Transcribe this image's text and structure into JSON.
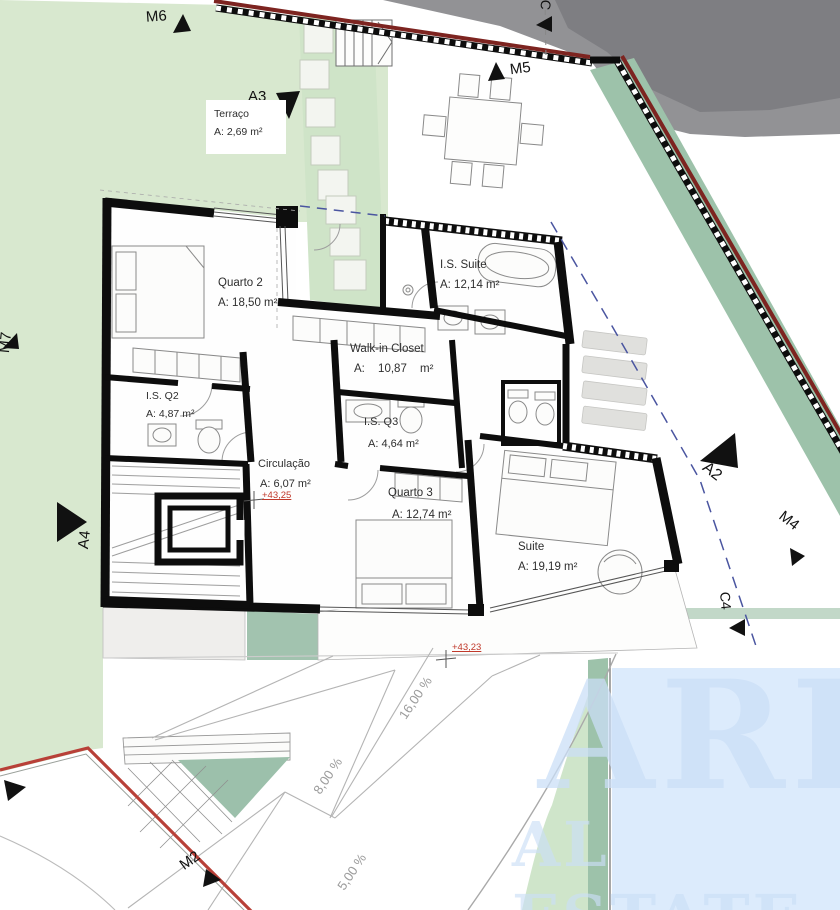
{
  "rooms": {
    "terraco": {
      "name": "Terraço",
      "area": "A: 2,69 m²"
    },
    "quarto2": {
      "name": "Quarto 2",
      "area": "A: 18,50 m²"
    },
    "is_suite": {
      "name": "I.S. Suite",
      "area": "A: 12,14 m²"
    },
    "walkin": {
      "name": "Walk-in Closet",
      "area": "A: 10,87 m²"
    },
    "is_q2": {
      "name": "I.S. Q2",
      "area": "A: 4,87 m²"
    },
    "is_q3": {
      "name": "I.S. Q3",
      "area": "A: 4,64 m²"
    },
    "circulacao": {
      "name": "Circulação",
      "area": "A: 6,07 m²"
    },
    "quarto3": {
      "name": "Quarto 3",
      "area": "A: 12,74 m²"
    },
    "suite": {
      "name": "Suite",
      "area": "A: 19,19 m²"
    }
  },
  "markers": {
    "m6": "M6",
    "m5": "M5",
    "m7": "M7",
    "m4": "M4",
    "m2": "M2",
    "a2": "A2",
    "a3": "A3",
    "a4": "A4",
    "c4": "C4",
    "c_top": "C"
  },
  "levels": {
    "upper": "+43,25",
    "lower": "+43,23"
  },
  "slopes": {
    "s16": "16,00 %",
    "s8": "8,00 %",
    "s5": "5,00 %"
  },
  "watermark": {
    "line1": "ARE",
    "line2": "AL ESTATE"
  },
  "colors": {
    "lawn": "#d8e8cf",
    "path_band": "#cfe4c8",
    "hedge": "#9dc2aa",
    "road": "#929295",
    "boundary_red": "#7d2420",
    "street_red": "#b84038",
    "section_blue": "#4a55a0",
    "watermark_blue": "#dcebfc",
    "wall_black": "#0d0d0d"
  }
}
